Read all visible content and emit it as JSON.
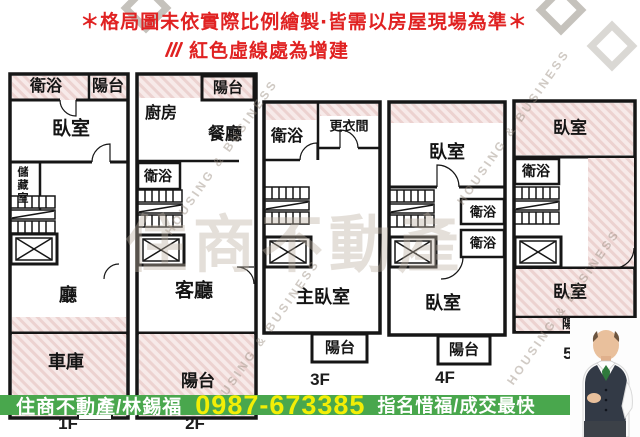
{
  "header": {
    "line1": "＊格局圖未依實際比例繪製‧皆需以房屋現場為準＊",
    "line2": "紅色虛線處為增建"
  },
  "floors": {
    "f1": {
      "label": "1F",
      "rooms": {
        "bath": "衛浴",
        "balcony": "陽台",
        "bedroom": "臥室",
        "storage": "儲藏室",
        "hall": "廳",
        "garage": "車庫"
      }
    },
    "f2": {
      "label": "2F",
      "rooms": {
        "balcony_top": "陽台",
        "kitchen": "廚房",
        "dining": "餐廳",
        "bath": "衛浴",
        "living": "客廳",
        "balcony_bottom": "陽台"
      }
    },
    "f3": {
      "label": "3F",
      "rooms": {
        "bath": "衛浴",
        "dressing": "更衣間",
        "master": "主臥室",
        "balcony": "陽台"
      }
    },
    "f4": {
      "label": "4F",
      "rooms": {
        "bedroom_top": "臥室",
        "bath1": "衛浴",
        "bath2": "衛浴",
        "bedroom_bottom": "臥室",
        "balcony": "陽台"
      }
    },
    "f5": {
      "label": "5F",
      "rooms": {
        "bedroom_top": "臥室",
        "bath": "衛浴",
        "bedroom_bottom": "臥室",
        "balcony": "陽台"
      }
    }
  },
  "banner": {
    "agency": "住商不動產/林錫福",
    "phone": "0987-673385",
    "slogan": "指名惜福/成交最快"
  },
  "watermark": {
    "en": "HOUSING & BUSINESS",
    "brand": "住商不動產"
  },
  "colors": {
    "note_red": "#e02222",
    "hatch_fill": "#f7eae9",
    "hatch_stripe": "#ecd2d0",
    "wall_black": "#161616",
    "banner_green": "#49a74d",
    "phone_yellow": "#f2ee06",
    "banner_text_white": "#ffffff"
  }
}
